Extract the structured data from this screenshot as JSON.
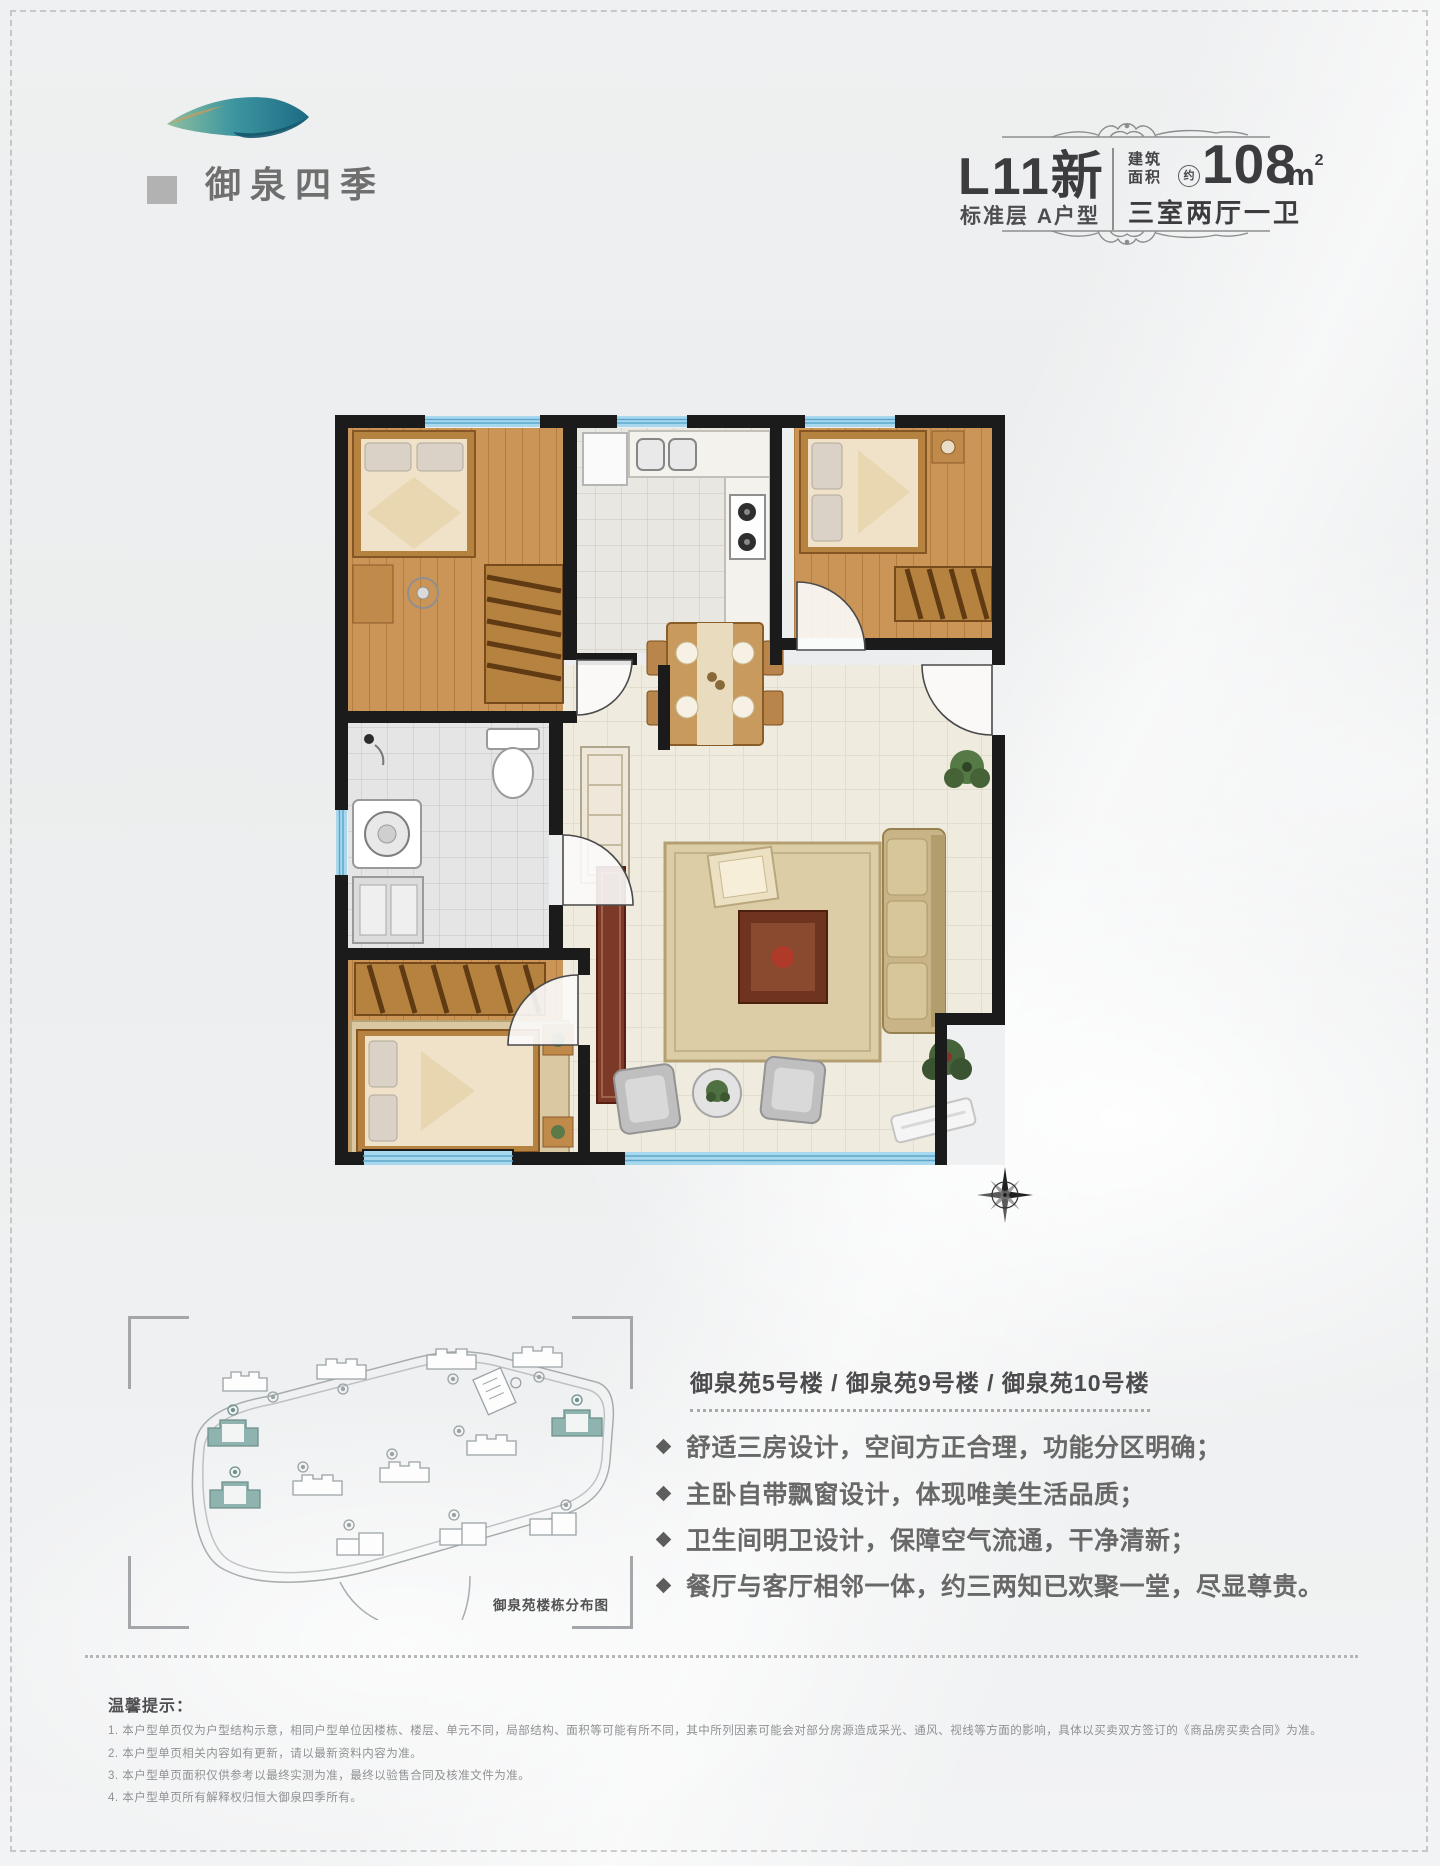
{
  "header": {
    "logo": {
      "name": "御泉四季"
    },
    "title_block": {
      "code": "L11新",
      "floor_type": "标准层 A户型",
      "area_label_line1": "建筑",
      "area_label_line2": "面积",
      "approx_mark": "约",
      "area_value": "108",
      "area_unit": "m",
      "area_unit_sup": "2",
      "layout": "三室两厅一卫"
    }
  },
  "site_plan": {
    "caption": "御泉苑楼栋分布图",
    "highlight_color": "#8fb3ae"
  },
  "details": {
    "buildings_line": "御泉苑5号楼 / 御泉苑9号楼 / 御泉苑10号楼",
    "bullets": [
      "舒适三房设计，空间方正合理，功能分区明确；",
      "主卧自带飘窗设计，体现唯美生活品质；",
      "卫生间明卫设计，保障空气流通，干净清新；",
      "餐厅与客厅相邻一体，约三两知已欢聚一堂，尽显尊贵。"
    ]
  },
  "disclaimer": {
    "title": "温馨提示：",
    "items": [
      "1. 本户型单页仅为户型结构示意，相同户型单位因楼栋、楼层、单元不同，局部结构、面积等可能有所不同，其中所列因素可能会对部分房源造成采光、通风、视线等方面的影响，具体以买卖双方签订的《商品房买卖合同》为准。",
      "2. 本户型单页相关内容如有更新，请以最新资料内容为准。",
      "3. 本户型单页面积仅供参考以最终实测为准，最终以验售合同及核准文件为准。",
      "4. 本户型单页所有解释权归恒大御泉四季所有。"
    ]
  },
  "floor_plan": {
    "wall_color": "#1b1b1b",
    "window_color": "#a8d8ee"
  }
}
